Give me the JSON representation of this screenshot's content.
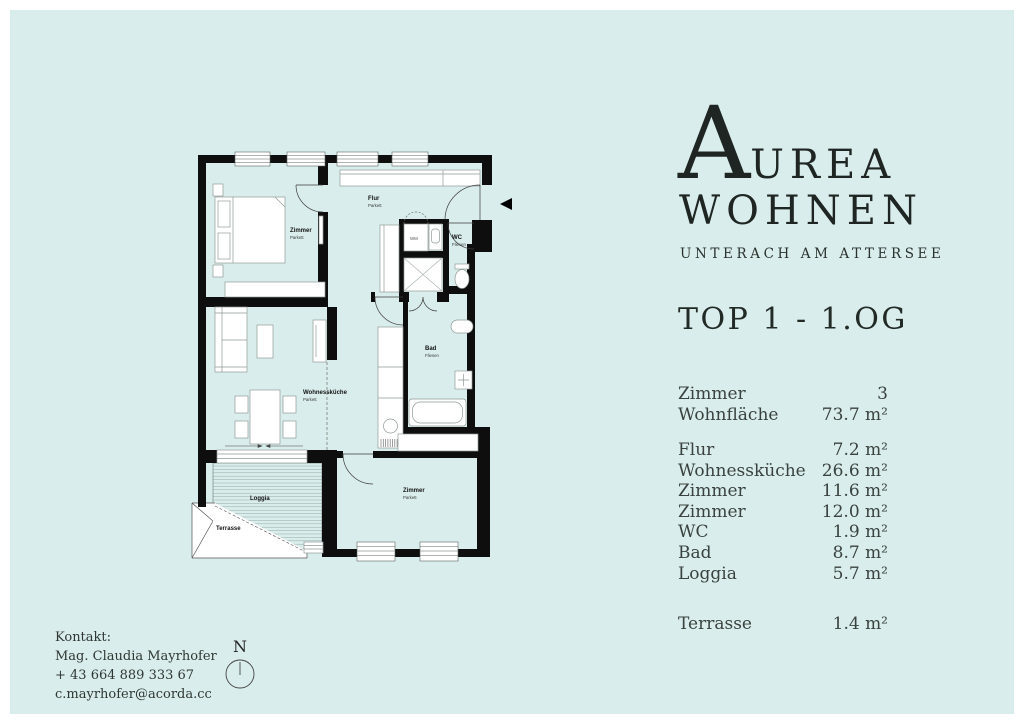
{
  "brand": {
    "initial": "A",
    "rest": "UREA",
    "line2": "WOHNEN",
    "tagline": "UNTERACH AM ATTERSEE"
  },
  "unit_title": "TOP 1 - 1.OG",
  "summary_rows": [
    {
      "label": "Zimmer",
      "value": "3"
    },
    {
      "label": "Wohnfläche",
      "value": "73.7 m²"
    }
  ],
  "room_rows": [
    {
      "label": "Flur",
      "value": "7.2 m²"
    },
    {
      "label": "Wohnessküche",
      "value": "26.6 m²"
    },
    {
      "label": "Zimmer",
      "value": "11.6 m²"
    },
    {
      "label": "Zimmer",
      "value": "12.0 m²"
    },
    {
      "label": "WC",
      "value": "1.9 m²"
    },
    {
      "label": "Bad",
      "value": "8.7 m²"
    },
    {
      "label": "Loggia",
      "value": "5.7 m²"
    }
  ],
  "outdoor_rows": [
    {
      "label": "Terrasse",
      "value": "1.4 m²"
    }
  ],
  "contact": {
    "heading": "Kontakt:",
    "name": "Mag. Claudia Mayrhofer",
    "phone": "+ 43 664 889 333 67",
    "email": "c.mayrhofer@acorda.cc"
  },
  "compass": {
    "label": "N"
  },
  "floorplan": {
    "labels": {
      "bedroom1": {
        "name": "Zimmer",
        "material": "Parkett"
      },
      "flur": {
        "name": "Flur",
        "material": "Parkett"
      },
      "wm": "WM",
      "wc": {
        "name": "WC",
        "material": "Fliesen"
      },
      "bad": {
        "name": "Bad",
        "material": "Fliesen"
      },
      "living": {
        "name": "Wohnessküche",
        "material": "Parkett"
      },
      "bedroom2": {
        "name": "Zimmer",
        "material": "Parkett"
      },
      "loggia": "Loggia",
      "terrace": "Terrasse"
    }
  },
  "colors": {
    "background": "#d9edec",
    "frame": "#ffffff",
    "wall": "#0e0e0e",
    "ink": "#222a26"
  }
}
